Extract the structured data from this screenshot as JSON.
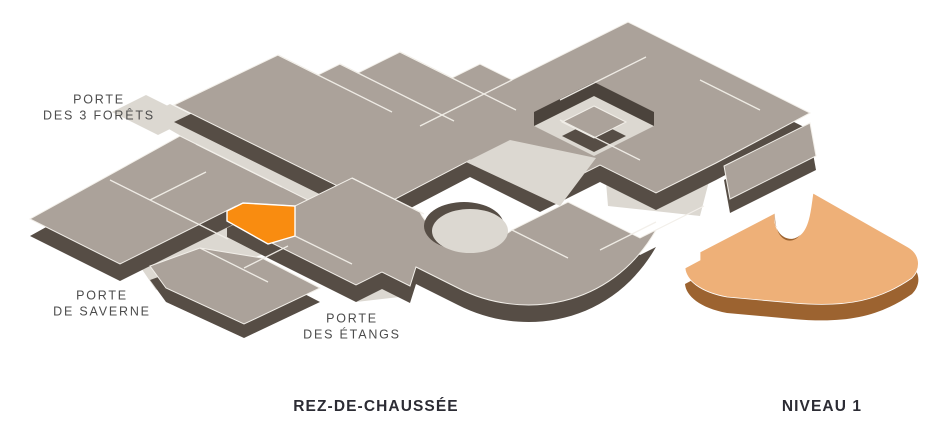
{
  "map": {
    "title": "REZ-DE-CHAUSSÉE",
    "entrances": [
      {
        "id": "porte-des-3-forets",
        "line1": "PORTE",
        "line2": "DES 3 FORÊTS"
      },
      {
        "id": "porte-de-saverne",
        "line1": "PORTE",
        "line2": "DE SAVERNE"
      },
      {
        "id": "porte-des-etangs",
        "line1": "PORTE",
        "line2": "DES ÉTANGS"
      }
    ],
    "floors": [
      {
        "id": "rez-de-chaussee",
        "label": "REZ-DE-CHAUSSÉE"
      },
      {
        "id": "niveau-1",
        "label": "NIVEAU 1"
      }
    ],
    "colors": {
      "highlighted_store": "#f98c10",
      "level1_top": "#eeb078",
      "level1_side": "#9c6330",
      "roof": "#aba29a",
      "roof_side": "#564d45",
      "walkway": "#dcd8d1",
      "entrance_label": "#4c4c4c",
      "floor_label": "#2c2c34",
      "background": "#ffffff"
    }
  }
}
